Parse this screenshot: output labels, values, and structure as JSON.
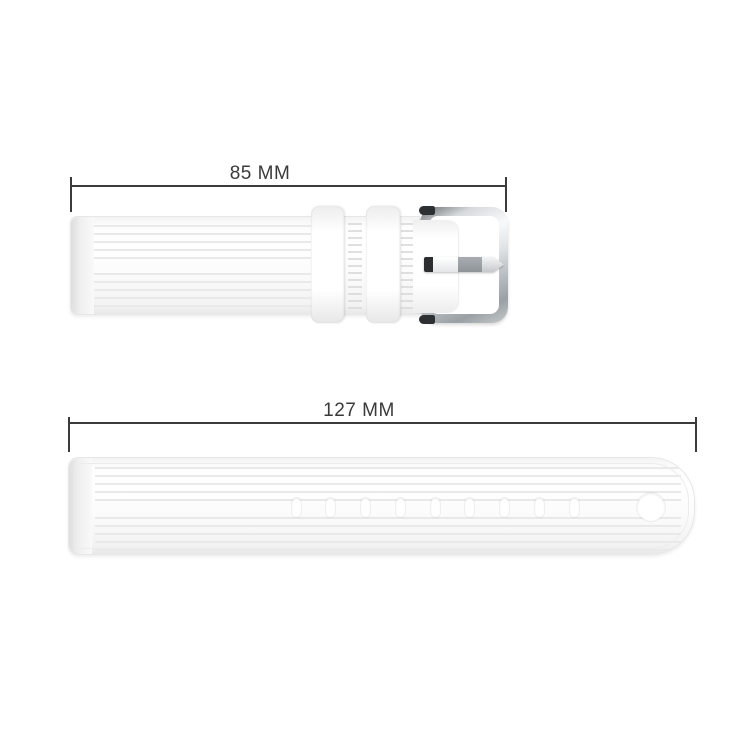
{
  "measurements": {
    "top": {
      "label": "85 MM",
      "value_mm": 85,
      "unit": "MM"
    },
    "bottom": {
      "label": "127 MM",
      "value_mm": 127,
      "unit": "MM"
    }
  },
  "product": {
    "short_strap": {
      "part": "buckle-side strap",
      "keeper_count": 2,
      "has_buckle": true
    },
    "long_strap": {
      "part": "holes-side strap",
      "pill_hole_count": 9,
      "round_hole_count": 1
    }
  },
  "holes_layout": {
    "first_center_x": 227,
    "step_x": 34.75,
    "pill_width": 9
  },
  "colors": {
    "background": "#ffffff",
    "dimension_line": "#3b3b3b",
    "label_text": "#3a3a3a",
    "strap_white": "#fdfdfd",
    "rib_gray": "#e9e9e9",
    "chrome_light": "#f8f9fa",
    "chrome_dark": "#9aa0a4",
    "prong_gray": "#9aa0a5",
    "accent_dark": "#2d3033"
  }
}
